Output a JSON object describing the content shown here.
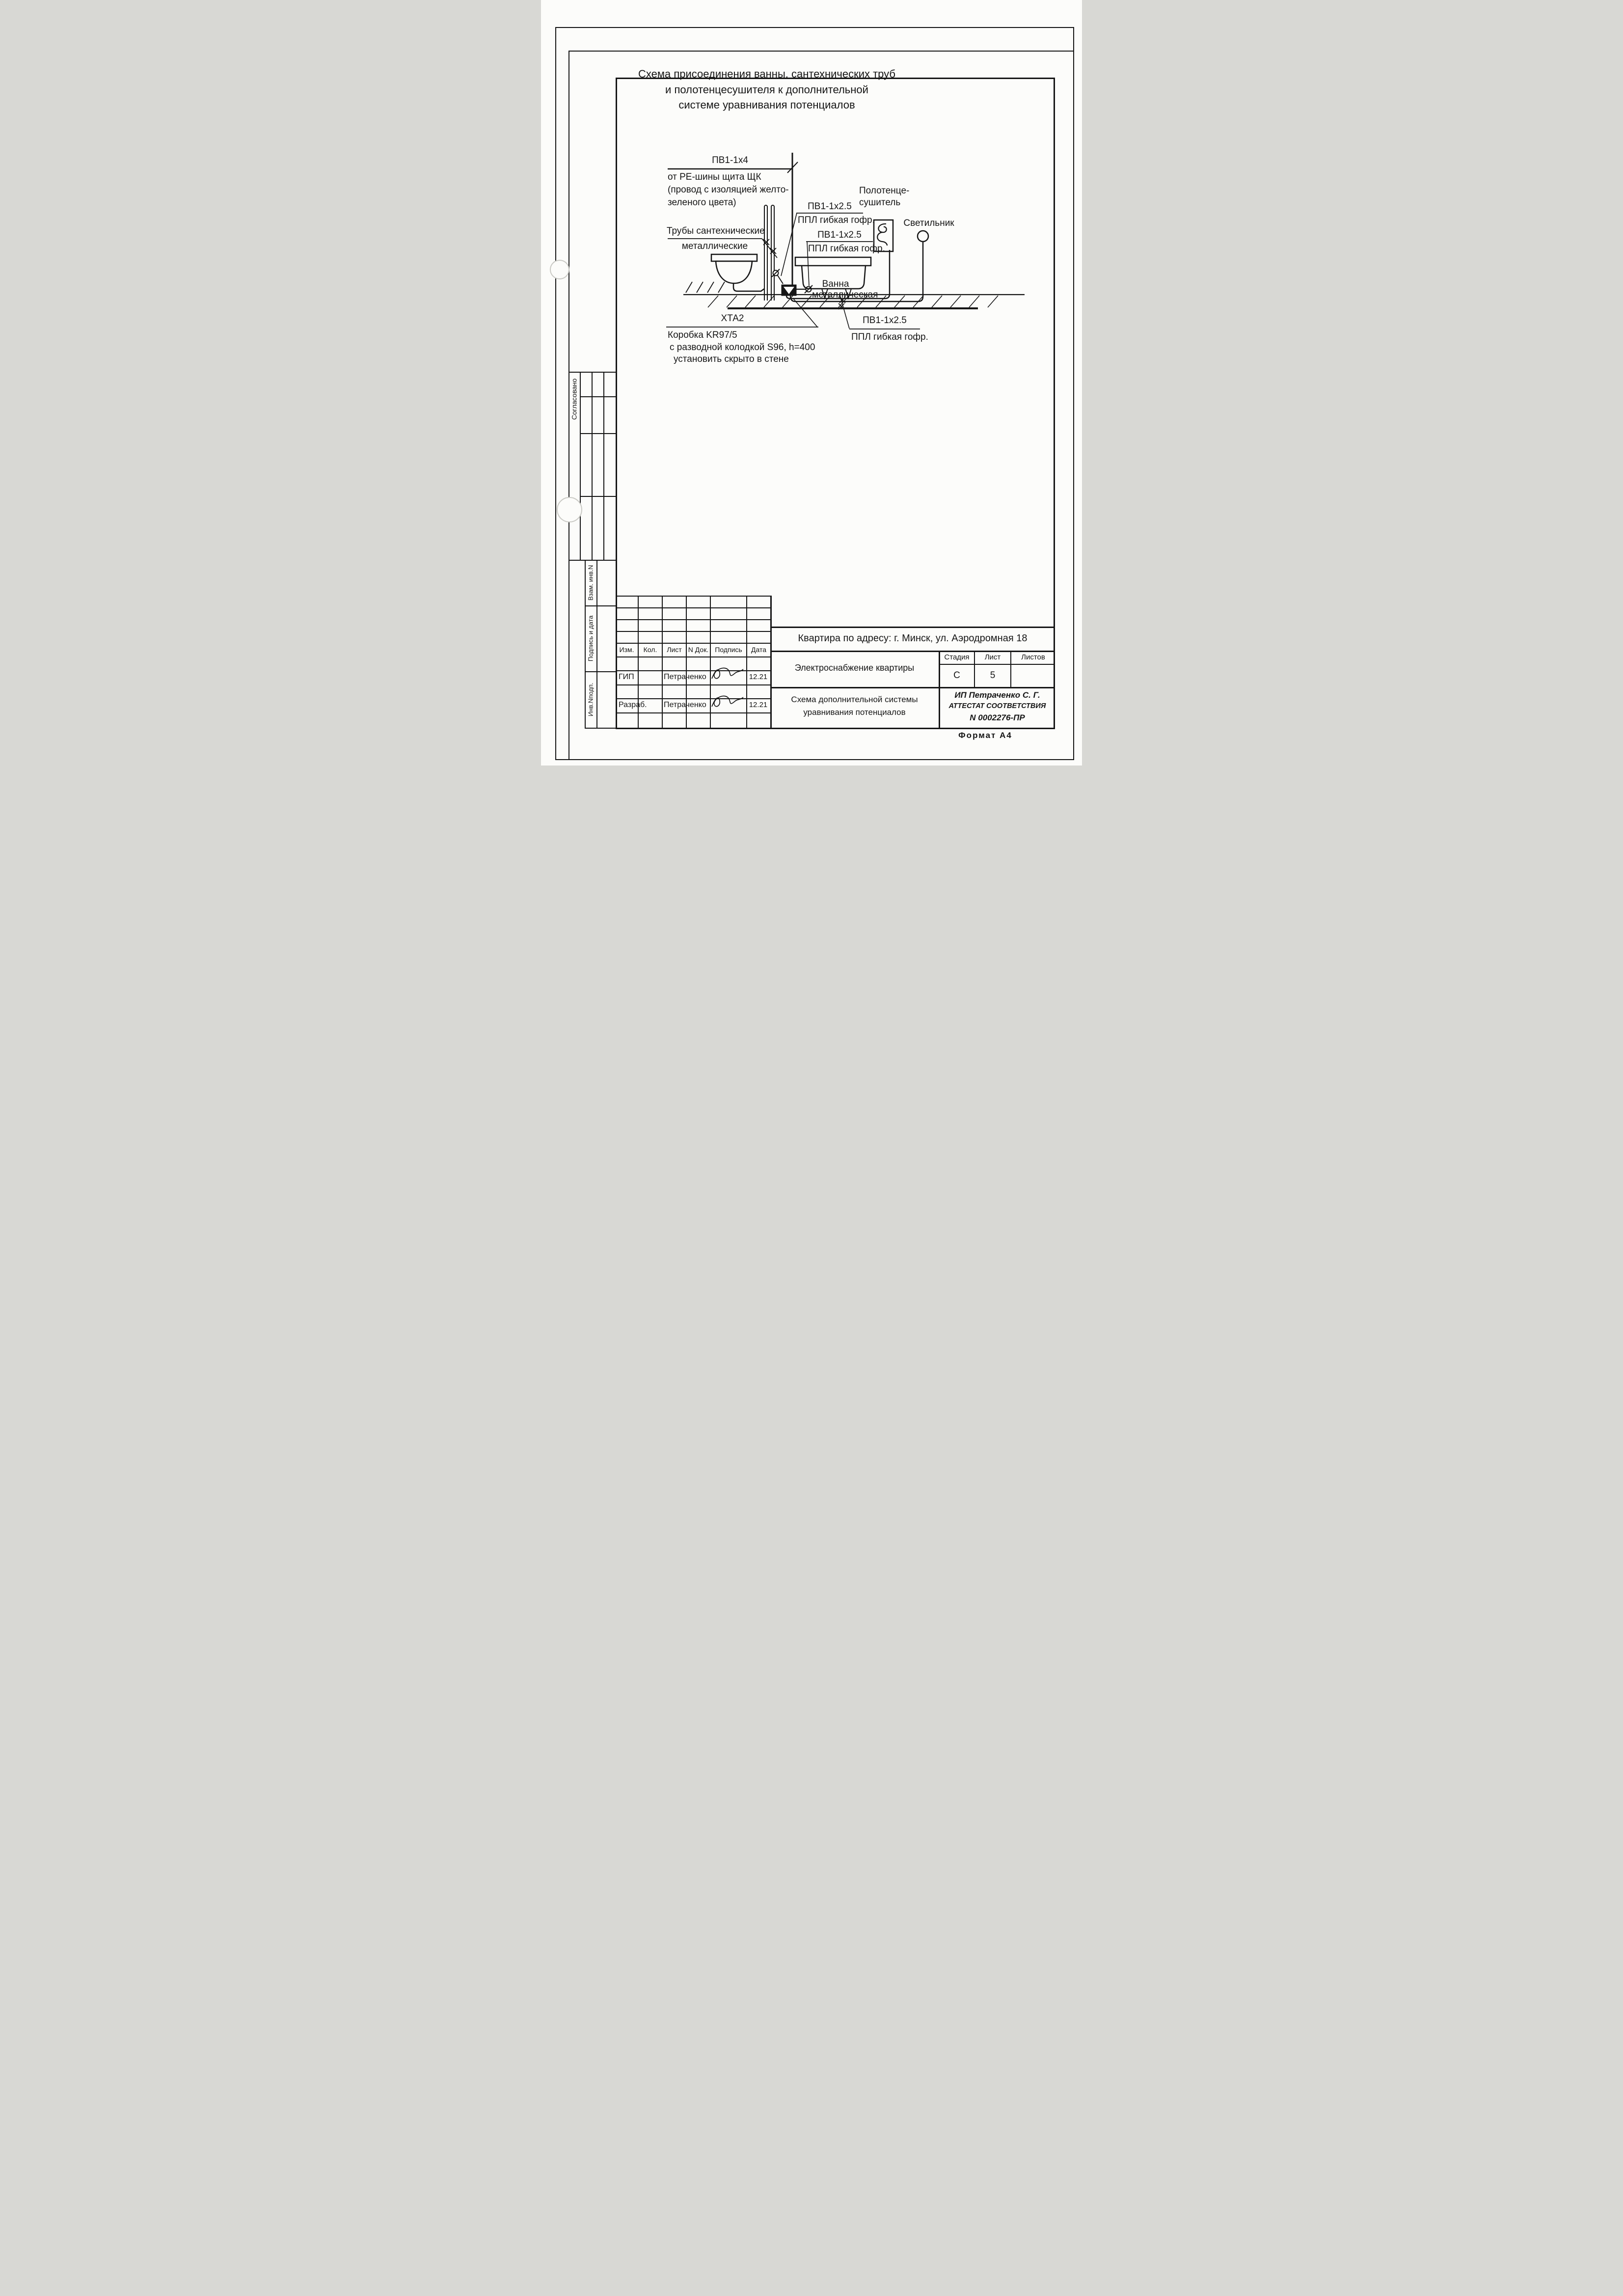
{
  "title": {
    "line1": "Схема присоединения ванны, сантехнических труб",
    "line2": "и полотенцесушителя   к дополнительной",
    "line3": "системе уравнивания потенциалов"
  },
  "diagram": {
    "riser_label": "ПВ1-1х4",
    "riser_note1": "от PE-шины щита ЩК",
    "riser_note2": "(провод с изоляцией желто-",
    "riser_note3": "зеленого цвета)",
    "pipes_label1": "Трубы сантехнические",
    "pipes_label2": "металлические",
    "wire_a_label": "ПВ1-1х2.5",
    "wire_a_note": "ППЛ гибкая гофр.",
    "wire_b_label": "ПВ1-1х2.5",
    "wire_b_note": "ППЛ гибкая гофр.",
    "wire_c_label": "ПВ1-1х2.5",
    "wire_c_note": "ППЛ гибкая гофр.",
    "towel_label1": "Полотенце-",
    "towel_label2": "сушитель",
    "light_label": "Светильник",
    "bath_label1": "Ванна",
    "bath_label2": "металлическая",
    "box_tag": "ХТА2",
    "box_note1": "Коробка KR97/5",
    "box_note2": "с разводной колодкой S96, h=400",
    "box_note3": "установить скрыто в стене"
  },
  "sidebar": {
    "agreed": "Согласовано",
    "vzam": "Взам. инв.N",
    "podpis": "Подпись и дата",
    "inv": "Инв.Nподп."
  },
  "titleblock": {
    "address": "Квартира по адресу: г. Минск, ул. Аэродромная 18",
    "columns": [
      "Изм.",
      "Кол.",
      "Лист",
      "N Док.",
      "Подпись",
      "Дата"
    ],
    "row_gip_role": "ГИП",
    "row_gip_name": "Петраченко",
    "row_gip_date": "12.21",
    "row_razrab_role": "Разраб.",
    "row_razrab_name": "Петраченко",
    "row_razrab_date": "12.21",
    "project": "Электроснабжение квартиры",
    "stage_label": "Стадия",
    "sheet_label": "Лист",
    "sheets_label": "Листов",
    "stage_value": "С",
    "sheet_value": "5",
    "sheets_value": "",
    "doc_line1": "Схема дополнительной системы",
    "doc_line2": "уравнивания потенциалов",
    "stamp_line1": "ИП Петраченко С. Г.",
    "stamp_line2": "АТТЕСТАТ СООТВЕТСТВИЯ",
    "stamp_line3": "N 0002276-ПР",
    "format_note": "Формат А4"
  }
}
